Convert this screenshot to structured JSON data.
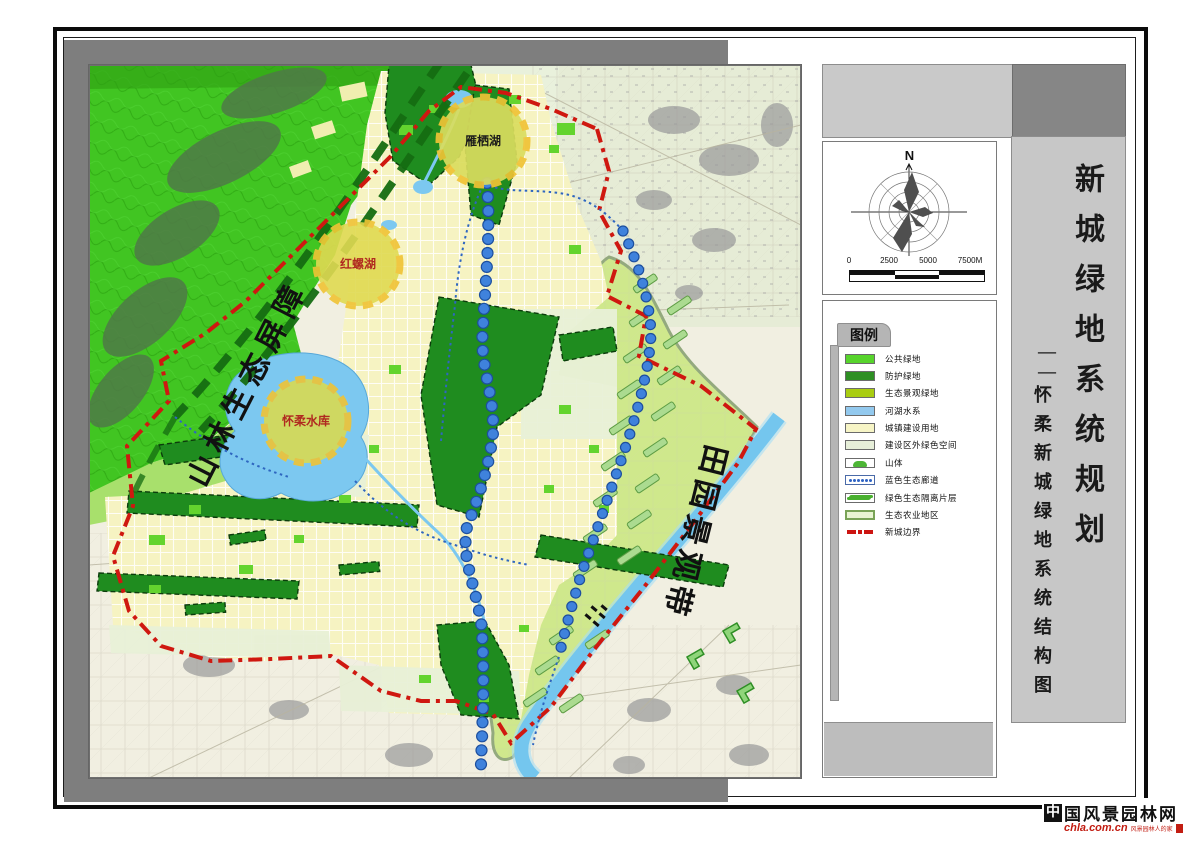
{
  "compass": {
    "north_label": "N",
    "scale_ticks": [
      "0",
      "2500",
      "5000",
      "7500M"
    ]
  },
  "legend": {
    "title": "图例",
    "items": [
      {
        "label": "公共绿地",
        "type": "fill",
        "color": "#57d42c"
      },
      {
        "label": "防护绿地",
        "type": "fill",
        "color": "#2e8f23"
      },
      {
        "label": "生态景观绿地",
        "type": "fill",
        "color": "#a9cd11"
      },
      {
        "label": "河湖水系",
        "type": "fill",
        "color": "#93c9ee"
      },
      {
        "label": "城镇建设用地",
        "type": "fill",
        "color": "#f7f5c6"
      },
      {
        "label": "建设区外绿色空间",
        "type": "fill",
        "color": "#e7efd9"
      },
      {
        "label": "山体",
        "type": "mountain",
        "color": "#ffffff"
      },
      {
        "label": "蓝色生态廊道",
        "type": "dots",
        "color": "#ffffff"
      },
      {
        "label": "绿色生态隔离片层",
        "type": "squiggle",
        "color": "#ffffff"
      },
      {
        "label": "生态农业地区",
        "type": "fillBorder",
        "color": "#e8f4d2",
        "border": "#79a357"
      },
      {
        "label": "新城边界",
        "type": "dashdot",
        "color": "#ffffff"
      }
    ]
  },
  "title_block": {
    "main": "新城绿地系统规划",
    "dash": "——",
    "sub": "怀柔新城绿地系统结构图"
  },
  "map": {
    "labels": {
      "yanqi_lake": "雁栖湖",
      "hongluo_lake": "红螺湖",
      "huairou_reservoir": "怀柔水库",
      "mountain_barrier": "山林生态屏障",
      "pastoral_belt": "田园景观带"
    },
    "colors": {
      "mountain": "#41c522",
      "urban": "#f6f3c2",
      "water": "#7cc8f0",
      "agriculture": "#cfe88c",
      "protective_green": "#1f8c1f",
      "public_green": "#63d42e",
      "boundary_red": "#cf1810",
      "corridor_dot_blue": "#3f82dc",
      "countryside": "#f1efe1"
    }
  },
  "watermark": {
    "logo_char": "中",
    "name_rest": "国风景园林网",
    "url": "chla.com.cn",
    "tagline": "风景园林人的家"
  }
}
